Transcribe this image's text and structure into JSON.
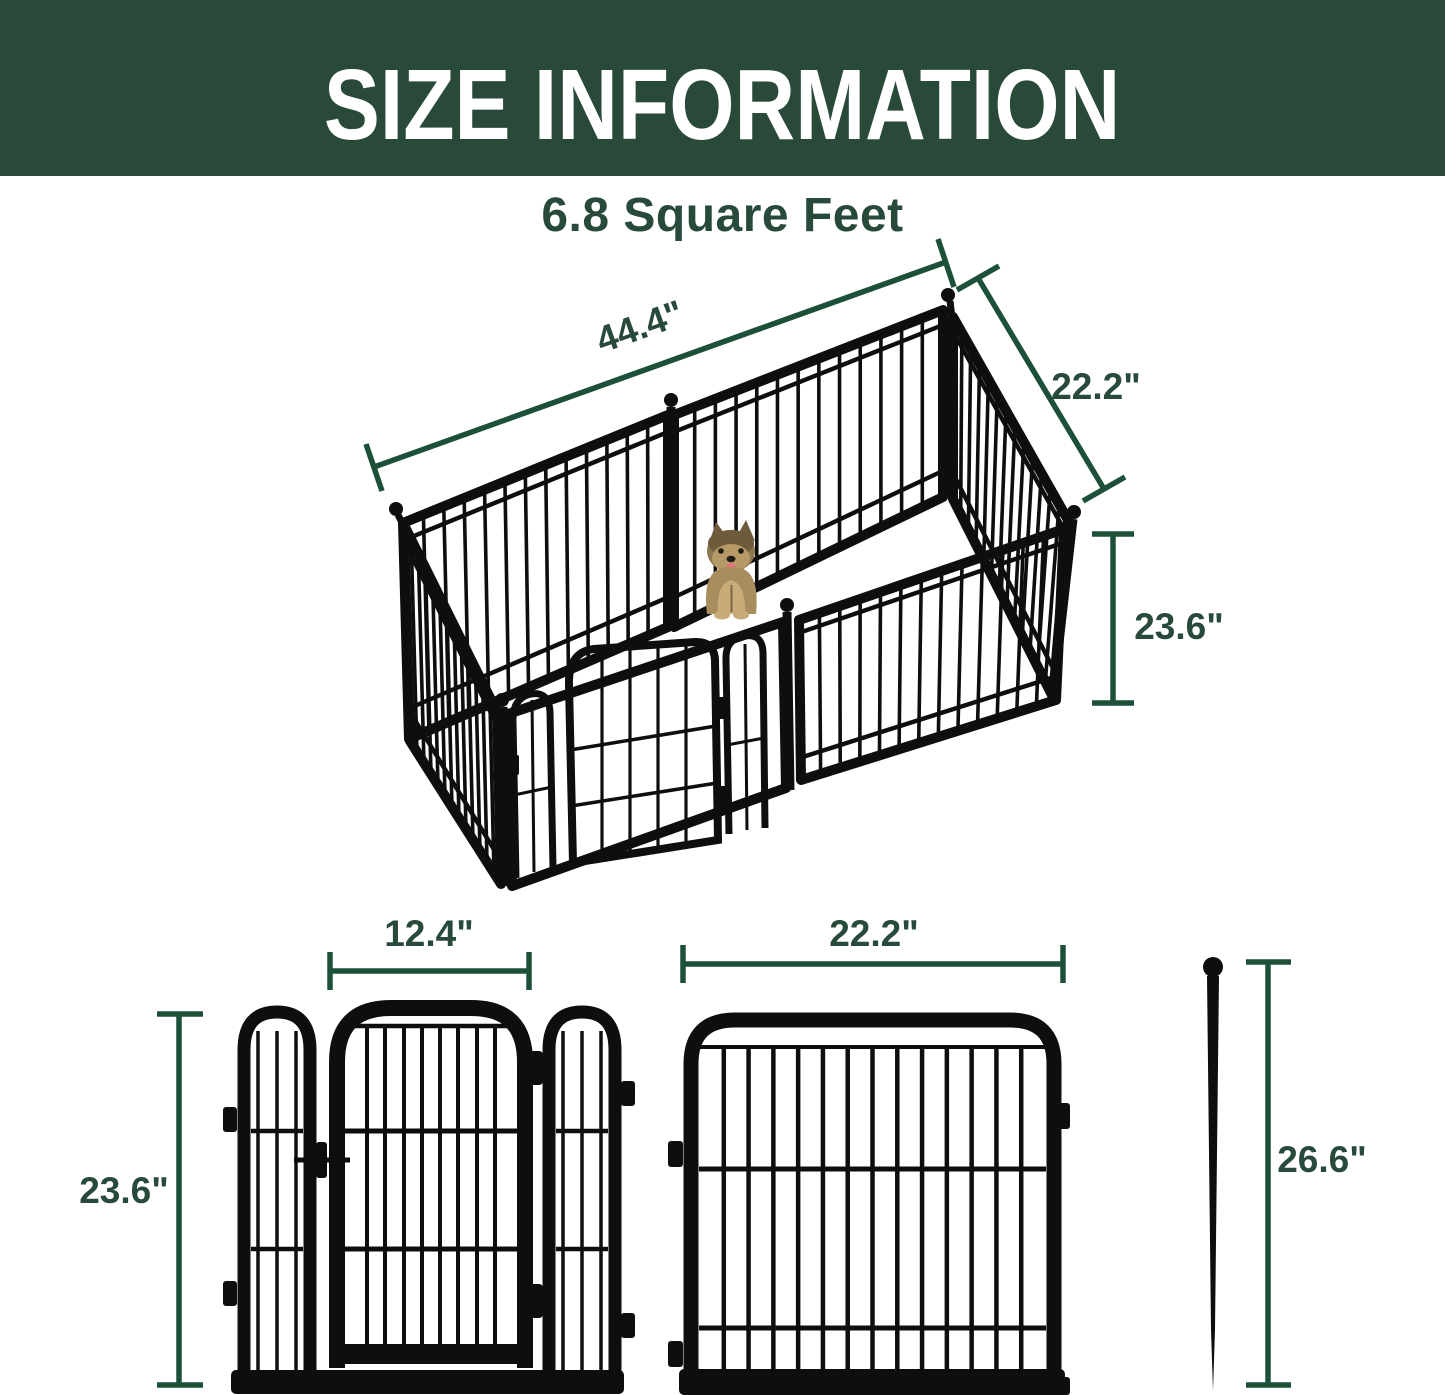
{
  "banner": {
    "title": "SIZE INFORMATION"
  },
  "pen": {
    "area_label": "6.8 Square Feet",
    "width": "44.4\"",
    "depth": "22.2\"",
    "height": "23.6\""
  },
  "components": {
    "gate_panel": {
      "door_width": "12.4\"",
      "height": "23.6\""
    },
    "regular_panel": {
      "width": "22.2\""
    },
    "ground_stake": {
      "length": "26.6\""
    }
  },
  "colors": {
    "banner_bg": "#2a4a39",
    "text_green": "#284a3b",
    "dimension_line": "#1d5038",
    "fence_black": "#0e0e0e",
    "dog_fur_dark": "#6e5b3c",
    "dog_fur_light": "#c7ac79",
    "dog_tongue": "#e5737f"
  }
}
